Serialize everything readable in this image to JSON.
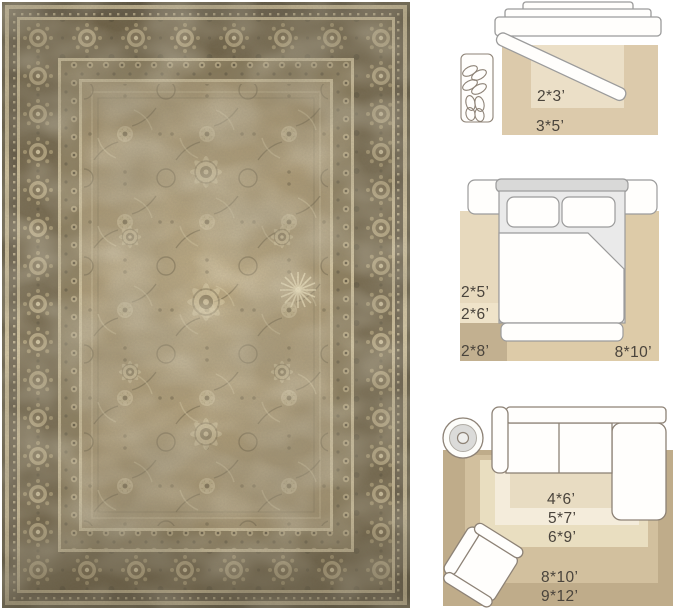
{
  "image_type": "rug product photo with room size guide",
  "rug": {
    "style": "vintage distressed oriental area rug",
    "palette": {
      "field": "#a89672",
      "field_light": "#c9b78f",
      "border_dark": "#716449",
      "border_secondary": "#8a7b5a",
      "cream": "#d5c6a0",
      "edge_dark": "#5a523d"
    }
  },
  "size_guide": {
    "text_color": "#4a443c",
    "furniture_outline_color": "#8d8276",
    "bed_outline_color": "#9b9b9b",
    "entryway": {
      "icons": [
        "door-icon",
        "shoe-mat-icon"
      ],
      "rug_colors": {
        "outer": "#dccaab",
        "inner": "#ebdfc7"
      },
      "labels": {
        "inner": "2*3’",
        "outer": "3*5’"
      }
    },
    "bedroom": {
      "icons": [
        "bed-icon"
      ],
      "rug_colors": {
        "main": "#ddcba8",
        "runner_2x5": "#e7d9bd",
        "runner_2x6": "#efe3c9",
        "runner_2x8": "#c2b090"
      },
      "labels": {
        "runner_a": "2*5’",
        "runner_b": "2*6’",
        "runner_c": "2*8’",
        "main": "8*10’"
      }
    },
    "living_room": {
      "icons": [
        "sectional-sofa-icon",
        "round-side-table-icon",
        "armchair-icon"
      ],
      "rug_colors": {
        "size_4x6": "#e8dcc2",
        "size_5x7": "#f4ecdb",
        "size_6x9": "#e9dec0",
        "size_8x10": "#d2c09e",
        "size_9x12": "#bfac8a"
      },
      "labels": {
        "a": "4*6’",
        "b": "5*7’",
        "c": "6*9’",
        "d": "8*10’",
        "e": "9*12’"
      }
    }
  }
}
